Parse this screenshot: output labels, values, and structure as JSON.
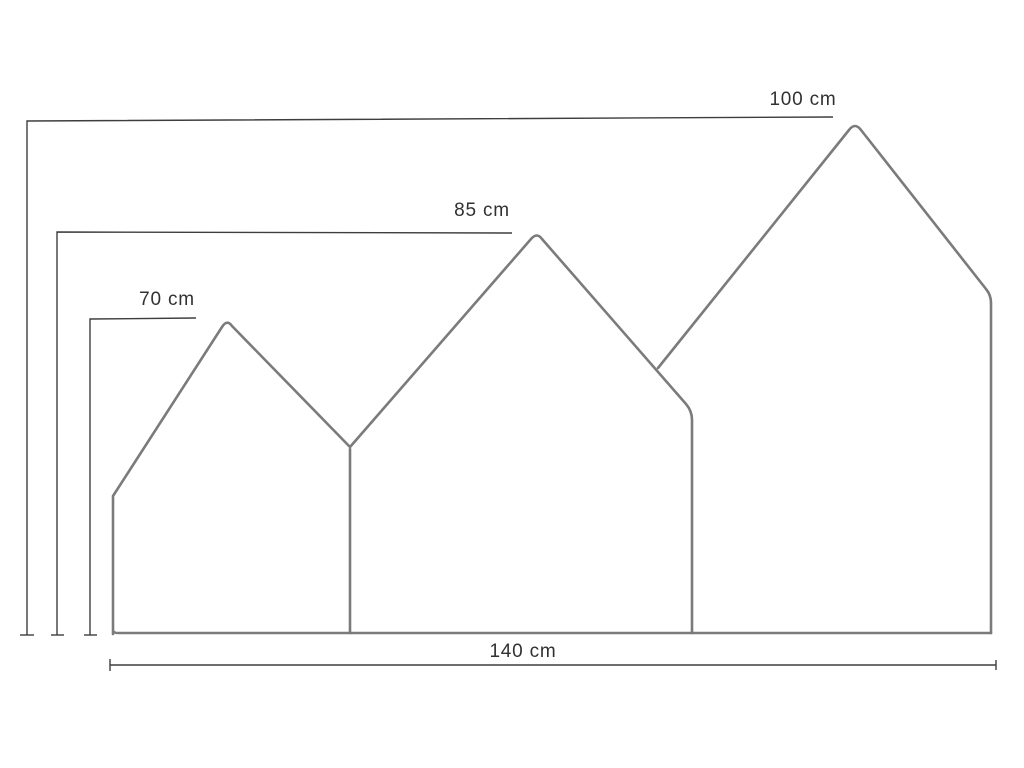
{
  "diagram": {
    "name": "house-shaped-headboard-dimension-drawing",
    "labels": {
      "large_house_height": "100 cm",
      "medium_house_height": "85 cm",
      "small_house_height": "70 cm",
      "total_width": "140 cm"
    },
    "dimensions_cm": {
      "large_house_height": 100,
      "medium_house_height": 85,
      "small_house_height": 70,
      "total_width": 140
    },
    "colors": {
      "outline": "#7b7b7b",
      "dimension_line": "#3e3e3e",
      "label_text": "#313131",
      "background": "#ffffff"
    }
  }
}
